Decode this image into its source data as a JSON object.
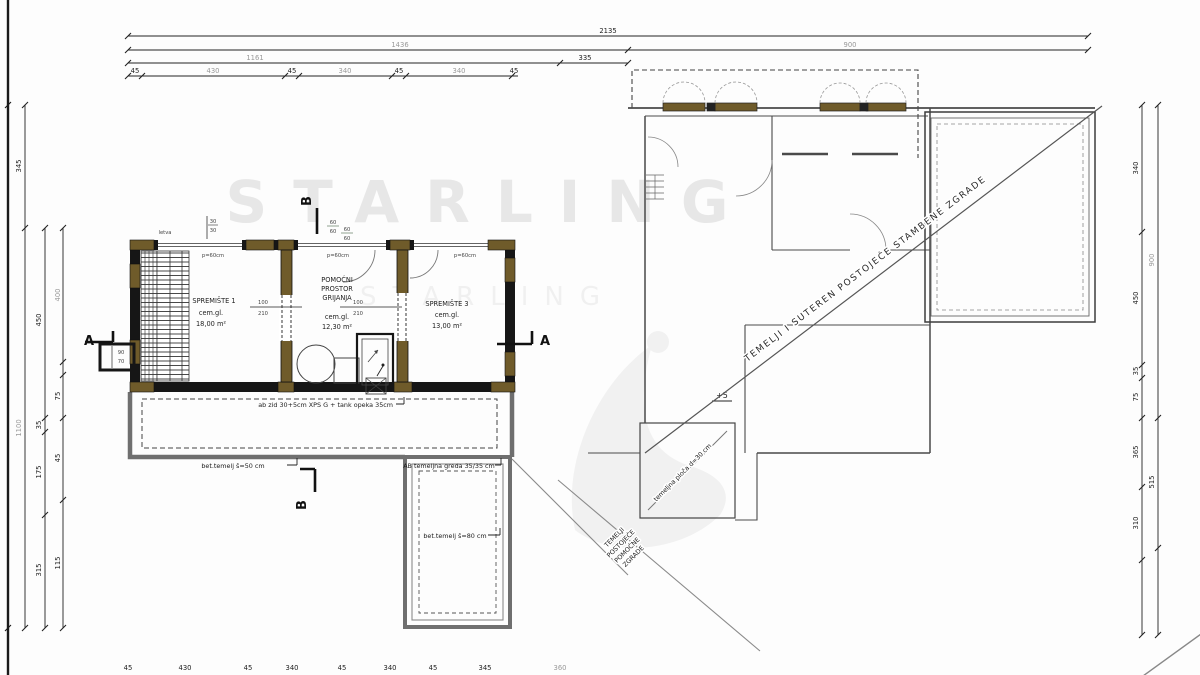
{
  "watermark": {
    "text": "STARLING"
  },
  "dims": {
    "top_total": "2135",
    "top_row2_left": "1436",
    "top_row2_right": "900",
    "top_row3_left": "1161",
    "top_row3_right": "335",
    "top_segments": [
      "45",
      "430",
      "45",
      "340",
      "45",
      "340",
      "45"
    ],
    "bottom_segments": [
      "45",
      "430",
      "45",
      "340",
      "45",
      "340",
      "45",
      "345",
      "360"
    ],
    "left_colA": [
      "345",
      "1100"
    ],
    "left_colB": [
      "450",
      "35",
      "175",
      "315"
    ],
    "left_colC": [
      "400",
      "75",
      "45",
      "115"
    ],
    "right_colA": [
      "340",
      "450",
      "35",
      "75",
      "365",
      "310"
    ],
    "right_colB": [
      "900",
      "515"
    ]
  },
  "rooms": [
    {
      "lines": [
        "SPREMIŠTE 1",
        "cem.gl.",
        "18,00 m²"
      ]
    },
    {
      "lines": [
        "POMOĆNI",
        "PROSTOR",
        "GRIJANJA",
        "cem.gl.",
        "12,30 m²"
      ]
    },
    {
      "lines": [
        "SPREMIŠTE 3",
        "cem.gl.",
        "13,00 m²"
      ]
    }
  ],
  "doors": {
    "num": "100",
    "den": "210"
  },
  "windows": {
    "parapet": "p=60cm"
  },
  "labels": {
    "letva": "letva",
    "chimney_num": "30",
    "chimney_den": "30",
    "vent_num": "60",
    "vent_den": "60",
    "entry_top": "90",
    "entry_bottom": "70",
    "plus5": "+5",
    "section_a": "A",
    "section_b": "B"
  },
  "notes": {
    "wall": "ab zid 30+5cm XPS G + tank opeka 35cm",
    "strip50": "bet.temelj š=50 cm",
    "grade": "AB temeljna greda 35/35 cm",
    "strip80": "bet.temelj š=80 cm",
    "plate": "temeljna ploča d=30 cm",
    "main_diagonal": "TEMELJI I SUTEREN POSTOJEĆE STAMBENE ZGRADE",
    "aux_diagonal_lines": [
      "TEMELJI",
      "POSTOJEĆE",
      "POMOĆNE",
      "ZGRADE"
    ]
  },
  "colors": {
    "wall": "#161616",
    "pilaster": "#6f5b2a",
    "foundation_gray": "#6f6f6f",
    "line_thin": "#4a4a4a",
    "watermark": "#e7e7e7"
  }
}
